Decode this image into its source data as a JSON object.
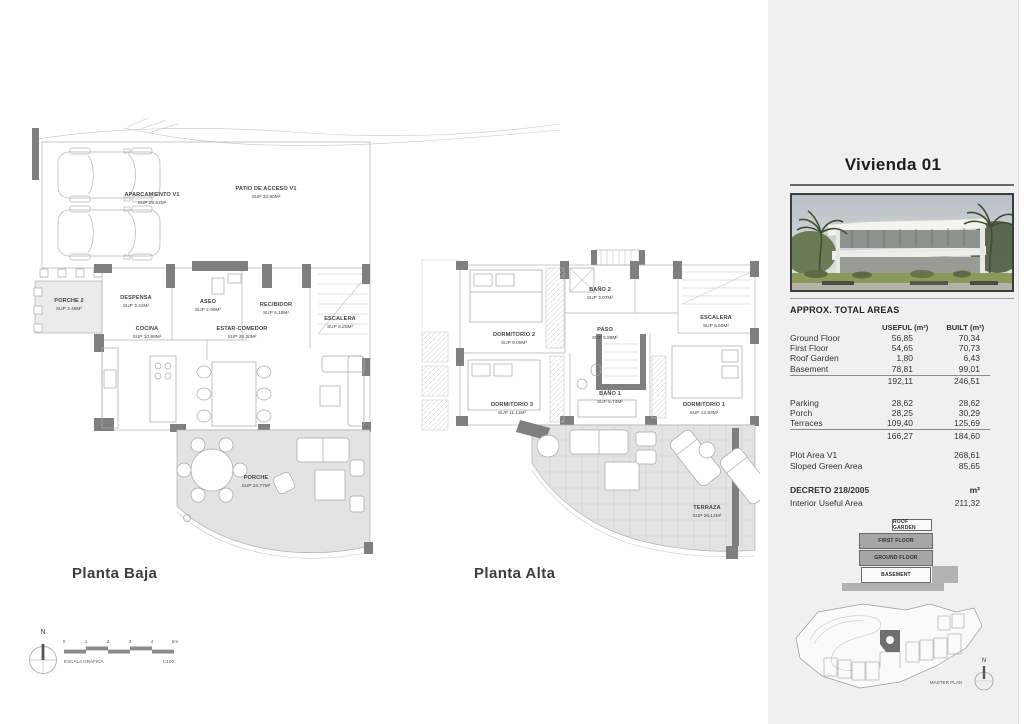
{
  "panel": {
    "title": "Vivienda 01",
    "areas_title": "APPROX. TOTAL AREAS",
    "columns": {
      "useful": "USEFUL (m²)",
      "built": "BUILT (m²)"
    },
    "floor_rows": [
      {
        "label": "Ground Floor",
        "useful": "56,85",
        "built": "70,34"
      },
      {
        "label": "First Floor",
        "useful": "54,65",
        "built": "70,73"
      },
      {
        "label": "Roof Garden",
        "useful": "1,80",
        "built": "6,43"
      },
      {
        "label": "Basement",
        "useful": "78,81",
        "built": "99,01"
      }
    ],
    "floor_total": {
      "useful": "192,11",
      "built": "246,51"
    },
    "exterior_rows": [
      {
        "label": "Parking",
        "useful": "28,62",
        "built": "28,62"
      },
      {
        "label": "Porch",
        "useful": "28,25",
        "built": "30,29"
      },
      {
        "label": "Terraces",
        "useful": "109,40",
        "built": "125,69"
      }
    ],
    "exterior_total": {
      "useful": "166,27",
      "built": "184,60"
    },
    "plot_rows": [
      {
        "label": "Plot Area V1",
        "value": "268,61"
      },
      {
        "label": "Sloped Green Area",
        "value": "85,65"
      }
    ],
    "decreto": {
      "label": "DECRETO 218/2005",
      "unit": "m²",
      "row_label": "Interior Useful Area",
      "value": "211,32"
    },
    "stack": [
      "ROOF GARDEN",
      "FIRST FLOOR",
      "GROUND FLOOR",
      "BASEMENT"
    ],
    "master_plan_label": "MASTER PLAN"
  },
  "plans": {
    "baja": {
      "title": "Planta Baja",
      "labels": [
        {
          "name": "APARCAMIENTO V1",
          "sup": "SUP 28.62M²"
        },
        {
          "name": "PATIO DE ACCESO V1",
          "sup": "SUP 33.90M²"
        },
        {
          "name": "PORCHE 2",
          "sup": "SUP 3.48M²"
        },
        {
          "name": "DESPENSA",
          "sup": "SUP 3.41M²"
        },
        {
          "name": "ASEO",
          "sup": "SUP 2.90M²"
        },
        {
          "name": "RECIBIDOR",
          "sup": "SUP 5.16M²"
        },
        {
          "name": "COCINA",
          "sup": "SUP 10.86M²"
        },
        {
          "name": "ESTAR-COMEDOR",
          "sup": "SUP 28.30M²"
        },
        {
          "name": "ESCALERA",
          "sup": "SUP 6.20M²"
        },
        {
          "name": "PORCHE",
          "sup": "SUP 24.77M²"
        }
      ]
    },
    "alta": {
      "title": "Planta Alta",
      "labels": [
        {
          "name": "DORMITORIO 2",
          "sup": "SUP 9.00M²"
        },
        {
          "name": "BAÑO 2",
          "sup": "SUP 3.07M²"
        },
        {
          "name": "PASO",
          "sup": "SUP 5.88M²"
        },
        {
          "name": "ESCALERA",
          "sup": "SUP 6.50M²"
        },
        {
          "name": "DORMITORIO 3",
          "sup": "SUP 11.11M²"
        },
        {
          "name": "BAÑO 1",
          "sup": "SUP 5.74M²"
        },
        {
          "name": "DORMITORIO 1",
          "sup": "SUP 12.83M²"
        },
        {
          "name": "TERRAZA",
          "sup": "SUP 26.12M²"
        }
      ]
    }
  },
  "scale": {
    "label": "ESCALA GRÁFICA",
    "ratio": "1:100",
    "ticks": [
      "0",
      "1",
      "2",
      "3",
      "4",
      "5m"
    ]
  },
  "compass": {
    "north": "N"
  },
  "colors": {
    "wall": "#7f7f7f",
    "shading": "#e3e3e3",
    "panel_bg": "#f0f0f0"
  }
}
